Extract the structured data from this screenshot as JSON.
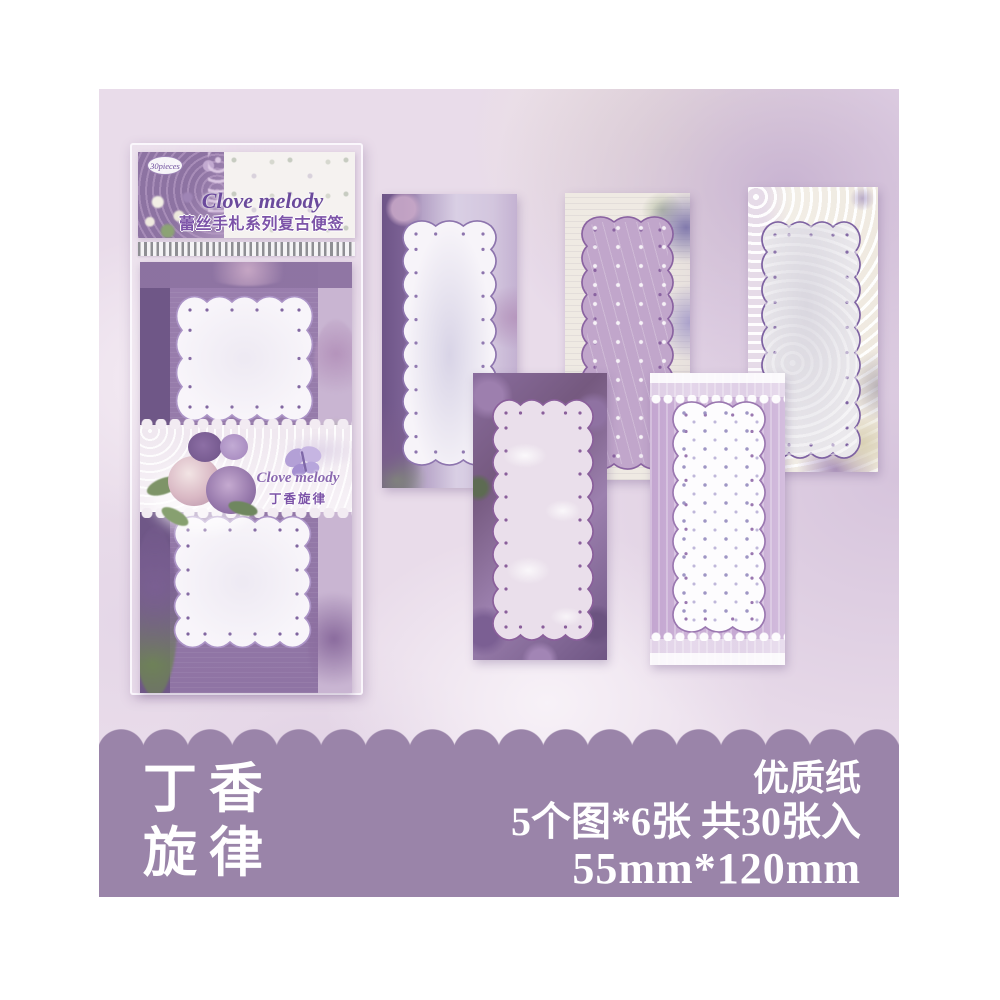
{
  "package": {
    "badge": "30pieces",
    "brand": "Clove melody",
    "series": "蕾丝手札系列复古便签纸",
    "label_brand": "Clove melody",
    "label_name": "丁香旋律"
  },
  "banner": {
    "title_line1": "丁香",
    "title_line2": "旋律",
    "quality": "优质纸",
    "count": "5个图*6张 共30张入",
    "size": "55mm*120mm"
  },
  "colors": {
    "banner_purple": "#9a84a9",
    "background_lavender": "#e9dcea",
    "accent_purple": "#7c53a8",
    "panel_border_purple": "#8a63a8",
    "page_margin": "#ffffff"
  }
}
